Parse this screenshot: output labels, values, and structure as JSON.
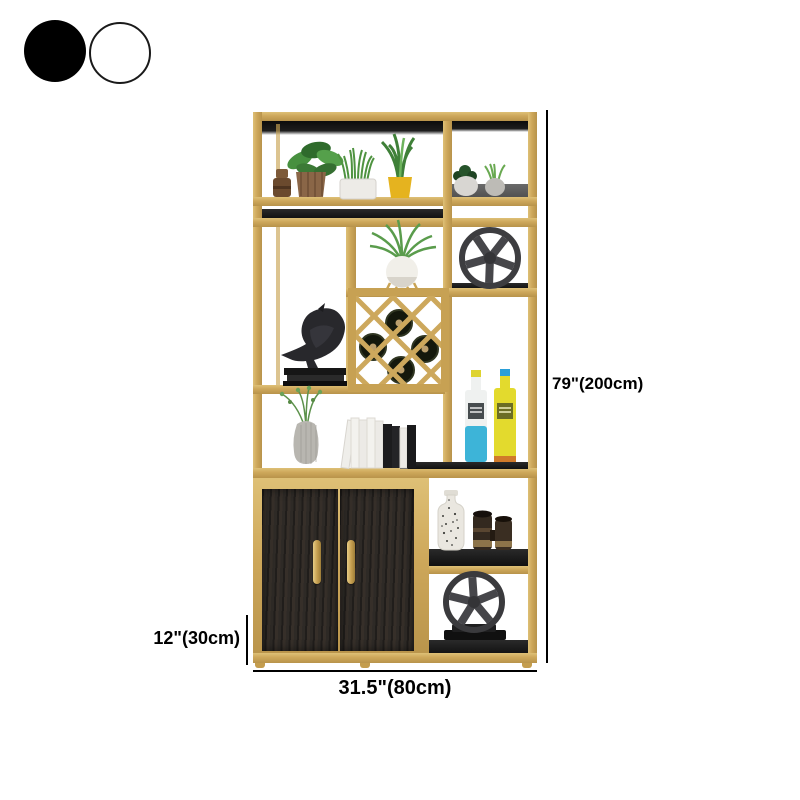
{
  "product": {
    "name": "gold-frame-display-shelf-with-cabinet",
    "frame_color": "#cda75a",
    "shelf_color": "#1c1c1c",
    "door_color": "#2e2a26",
    "decor_items": [
      "leafy-potted-plant",
      "jar-stack",
      "grass-potted-plant",
      "yellow-pot-spiky-plant",
      "mini-potted-plants",
      "air-plant-on-stand",
      "metal-wheel",
      "wine-rack-with-bottles",
      "bird-statue",
      "book-stack",
      "vase-with-sprigs",
      "book-row",
      "liquor-bottles",
      "speckled-vase",
      "binoculars",
      "metal-wheel-on-stand"
    ]
  },
  "swatches": [
    {
      "name": "black",
      "hex": "#000000"
    },
    {
      "name": "white",
      "hex": "#ffffff"
    }
  ],
  "dimensions": {
    "height": "79\"(200cm)",
    "width": "31.5\"(80cm)",
    "depth": "12\"(30cm)"
  },
  "dim_line_color": "#000000"
}
